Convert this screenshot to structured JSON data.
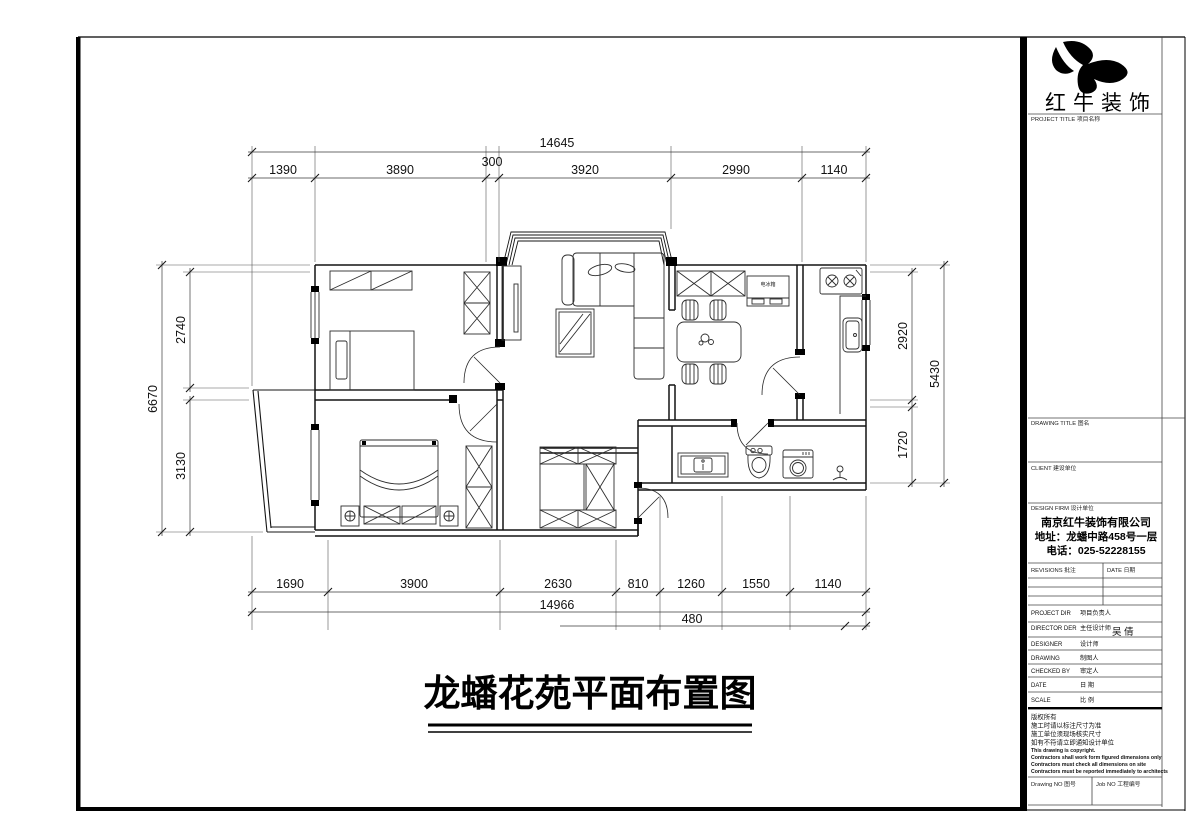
{
  "sheet": {
    "logo_company": "红牛装饰",
    "title_block": {
      "project_title_label": "PROJECT TITLE  项目名称",
      "drawing_title_label": "DRAWING TITLE  图名",
      "client_label": "CLIENT  建设单位",
      "design_firm_label": "DESIGN FIRM  设计单位",
      "firm_name": "南京红牛装饰有限公司",
      "firm_address": "地址：龙蟠中路458号一层",
      "firm_phone": "电话：025-52228155",
      "revisions_label": "REVISIONS  批注",
      "date_col_label": "DATE  日期",
      "rows": [
        {
          "en": "PROJECT DIR",
          "zh": "项目负责人"
        },
        {
          "en": "DIRECTOR DER",
          "zh": "主任设计师"
        },
        {
          "en": "DESIGNER",
          "zh": "设计师"
        },
        {
          "en": "DRAWING",
          "zh": "制图人"
        },
        {
          "en": "CHECKED BY",
          "zh": "审定人"
        },
        {
          "en": "DATE",
          "zh": "日 期"
        },
        {
          "en": "SCALE",
          "zh": "比 例"
        }
      ],
      "director_value": "吴 倩",
      "copyright_zh": [
        "版权所有",
        "施工时请以标注尺寸为准",
        "施工单位须现场核实尺寸",
        "如有不符请立即通知设计单位"
      ],
      "copyright_en": [
        "This drawing is copyright.",
        "Contractors shall work form figured dimensions only",
        "Contractors must check all dimensions on site",
        "Contractors must be reported immediately to architects"
      ],
      "drawing_no_label": "Drawing NO  图号",
      "job_no_label": "Job NO  工程编号"
    }
  },
  "plan": {
    "title": "龙蟠花苑平面布置图",
    "fridge_label": "电冰箱",
    "dims": {
      "top_total": "14645",
      "top_segments": [
        "1390",
        "3890",
        "300",
        "3920",
        "2990",
        "1140"
      ],
      "bottom_segments": [
        "1690",
        "3900",
        "2630",
        "810",
        "1260",
        "1550",
        "1140"
      ],
      "bottom_total": "14966",
      "bottom_extra": "480",
      "left_total": "6670",
      "left_segments": [
        "2740",
        "3130"
      ],
      "right_segments": [
        "2920",
        "1720"
      ],
      "right_total": "5430"
    }
  }
}
